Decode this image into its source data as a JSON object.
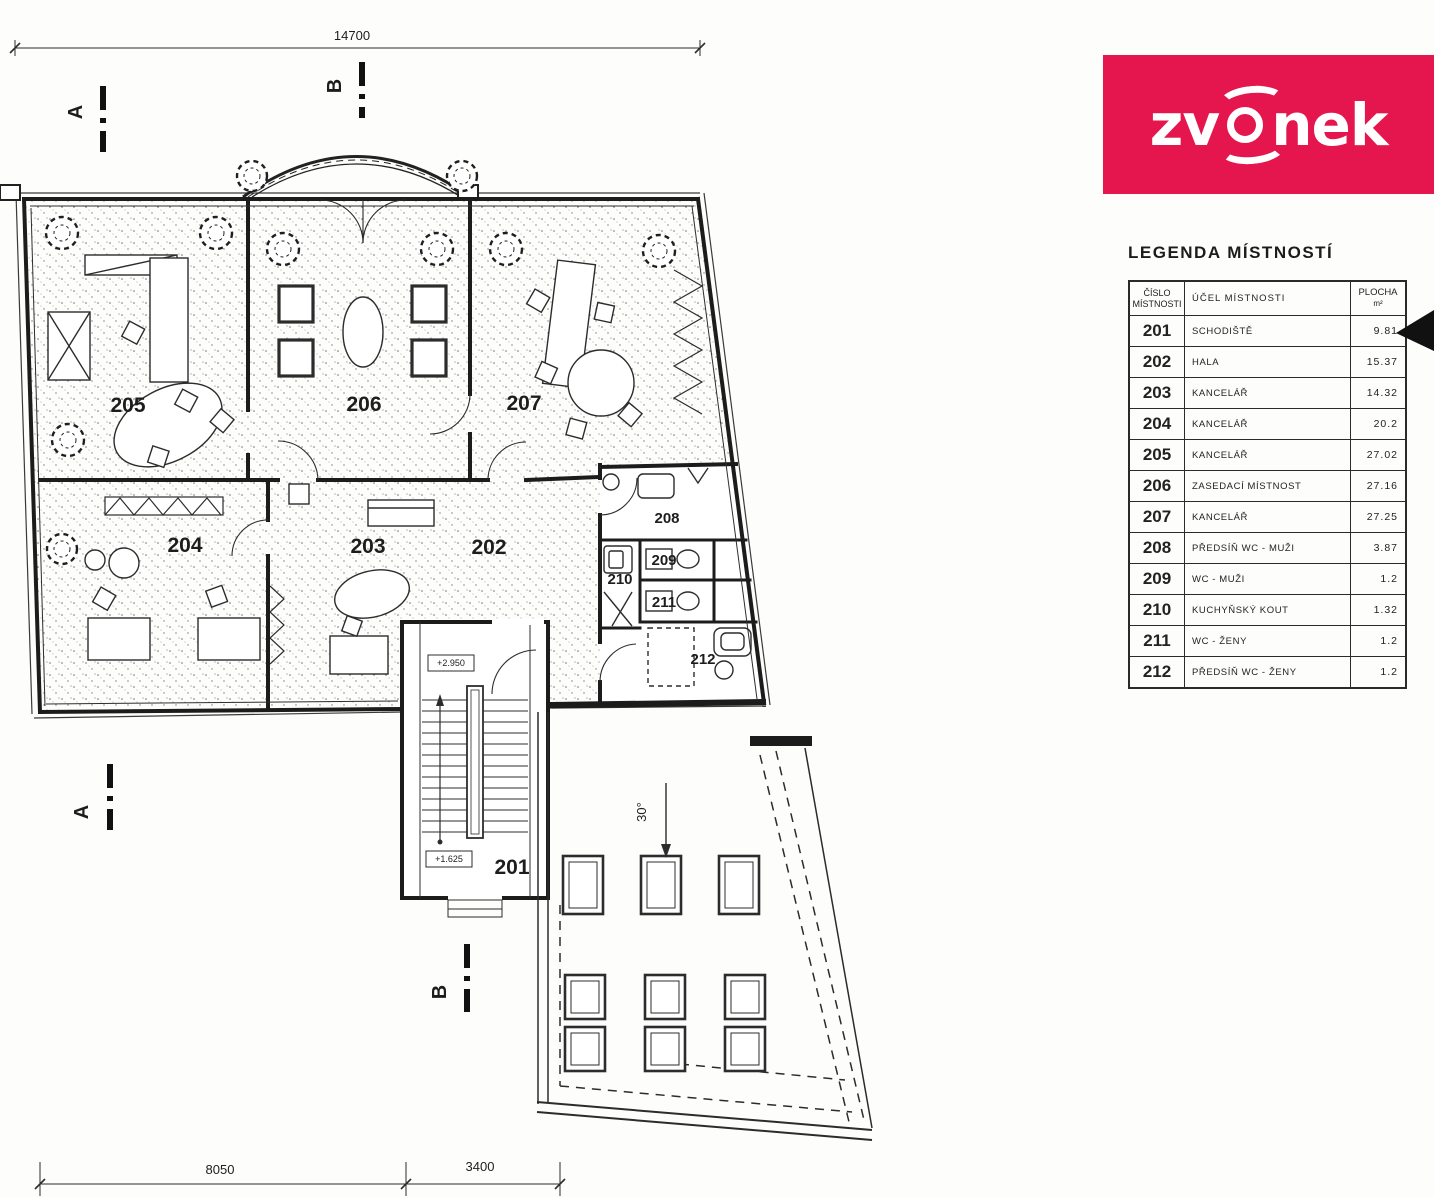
{
  "logo": {
    "name": "zvonek",
    "text_left": "zv",
    "text_right": "nek",
    "bg_color": "#e4164d",
    "text_color": "#ffffff"
  },
  "legend": {
    "title": "LEGENDA MÍSTNOSTÍ",
    "columns": {
      "number_line1": "ČÍSLO",
      "number_line2": "MÍSTNOSTI",
      "purpose": "ÚČEL MÍSTNOSTI",
      "area": "PLOCHA",
      "area_unit": "m²"
    }
  },
  "rooms": [
    {
      "number": "201",
      "purpose": "SCHODIŠTĚ",
      "area": "9.81"
    },
    {
      "number": "202",
      "purpose": "HALA",
      "area": "15.37"
    },
    {
      "number": "203",
      "purpose": "KANCELÁŘ",
      "area": "14.32"
    },
    {
      "number": "204",
      "purpose": "KANCELÁŘ",
      "area": "20.2"
    },
    {
      "number": "205",
      "purpose": "KANCELÁŘ",
      "area": "27.02"
    },
    {
      "number": "206",
      "purpose": "ZASEDACÍ MÍSTNOST",
      "area": "27.16"
    },
    {
      "number": "207",
      "purpose": "KANCELÁŘ",
      "area": "27.25"
    },
    {
      "number": "208",
      "purpose": "PŘEDSÍŇ WC - MUŽI",
      "area": "3.87"
    },
    {
      "number": "209",
      "purpose": "WC - MUŽI",
      "area": "1.2"
    },
    {
      "number": "210",
      "purpose": "KUCHYŇSKÝ KOUT",
      "area": "1.32"
    },
    {
      "number": "211",
      "purpose": "WC - ŽENY",
      "area": "1.2"
    },
    {
      "number": "212",
      "purpose": "PŘEDSÍŇ WC - ŽENY",
      "area": "1.2"
    }
  ],
  "plan": {
    "dimensions": {
      "top": "14700",
      "bottom_left": "8050",
      "bottom_right": "3400"
    },
    "markers": {
      "a": "A",
      "b": "B"
    },
    "elevations": {
      "upper": "+2.950",
      "lower": "+1.625"
    },
    "slope_label": "30°"
  }
}
